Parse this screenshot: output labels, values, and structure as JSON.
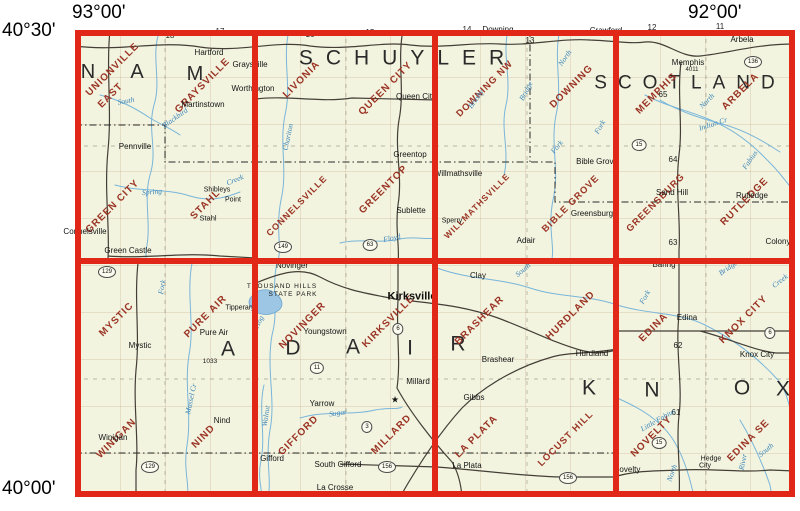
{
  "coords": {
    "top_left": "93°00'",
    "top_right": "92°00'",
    "left_top": "40°30'",
    "left_bottom": "40°00'"
  },
  "map": {
    "background": "#f2f4df",
    "grid_color": "#e02718",
    "quad_name_color": "#9b3425",
    "water_color": "#79b5da",
    "grid": {
      "cols": [
        75,
        255,
        435,
        616,
        795
      ],
      "rows": [
        30,
        261,
        497
      ]
    },
    "cells": [
      {
        "id": "r1c1",
        "quads": [
          "UNIONVILLE EAST",
          "GRAYSVILLE",
          "GREEN CITY",
          "STAHL"
        ]
      },
      {
        "id": "r1c2",
        "quads": [
          "LIVONIA",
          "QUEEN CITY",
          "CONNELSVILLE",
          "GREENTOP"
        ]
      },
      {
        "id": "r1c3",
        "quads": [
          "DOWNING NW",
          "DOWNING",
          "WILLMATHSVILLE",
          "BIBLE GROVE"
        ]
      },
      {
        "id": "r1c4",
        "quads": [
          "MEMPHIS",
          "ARBELA",
          "GREENSBURG",
          "RUTLEDGE"
        ]
      },
      {
        "id": "r2c1",
        "quads": [
          "MYSTIC",
          "PURE AIR",
          "WINIGAN",
          "NIND"
        ]
      },
      {
        "id": "r2c2",
        "quads": [
          "NOVINGER",
          "KIRKSVILLE",
          "GIFFORD",
          "MILLARD"
        ]
      },
      {
        "id": "r2c3",
        "quads": [
          "BRASHEAR",
          "HURDLAND",
          "LA PLATA",
          "LOCUST HILL"
        ]
      },
      {
        "id": "r2c4",
        "quads": [
          "EDINA",
          "KNOX CITY",
          "NOVELTY",
          "EDINA SE"
        ]
      }
    ],
    "labels": [
      {
        "t": "N",
        "cls": "county",
        "x": 88,
        "y": 72
      },
      {
        "t": "A",
        "cls": "county",
        "x": 137,
        "y": 72
      },
      {
        "t": "M",
        "cls": "county",
        "x": 195,
        "y": 74
      },
      {
        "t": "SCHUYLER",
        "cls": "county",
        "x": 408,
        "y": 58,
        "fs": 21,
        "ls": 13
      },
      {
        "t": "SCOTLAND",
        "cls": "county",
        "x": 690,
        "y": 83,
        "fs": 19,
        "ls": 11
      },
      {
        "t": "A",
        "cls": "county",
        "x": 228,
        "y": 349,
        "fs": 21
      },
      {
        "t": "D",
        "cls": "county",
        "x": 293,
        "y": 348,
        "fs": 21
      },
      {
        "t": "A",
        "cls": "county",
        "x": 353,
        "y": 347,
        "fs": 21
      },
      {
        "t": "I",
        "cls": "county",
        "x": 410,
        "y": 348,
        "fs": 21
      },
      {
        "t": "R",
        "cls": "county",
        "x": 458,
        "y": 344,
        "fs": 21
      },
      {
        "t": "K",
        "cls": "county",
        "x": 589,
        "y": 388,
        "fs": 21
      },
      {
        "t": "N",
        "cls": "county",
        "x": 652,
        "y": 390,
        "fs": 21
      },
      {
        "t": "O",
        "cls": "county",
        "x": 742,
        "y": 388,
        "fs": 21
      },
      {
        "t": "X",
        "cls": "county",
        "x": 783,
        "y": 389,
        "fs": 21
      },
      {
        "t": "UNIONVILLE",
        "cls": "quad",
        "x": 113,
        "y": 70,
        "rot": -45
      },
      {
        "t": "EAST",
        "cls": "quad",
        "x": 111,
        "y": 96,
        "rot": -45
      },
      {
        "t": "GRAYSVILLE",
        "cls": "quad",
        "x": 203,
        "y": 86,
        "rot": -45
      },
      {
        "t": "GREEN CITY",
        "cls": "quad",
        "x": 113,
        "y": 207,
        "rot": -45
      },
      {
        "t": "STAHL",
        "cls": "quad",
        "x": 206,
        "y": 205,
        "rot": -45
      },
      {
        "t": "LIVONIA",
        "cls": "quad",
        "x": 302,
        "y": 80,
        "rot": -45
      },
      {
        "t": "QUEEN CITY",
        "cls": "quad",
        "x": 386,
        "y": 89,
        "rot": -45
      },
      {
        "t": "CONNELSVILLE",
        "cls": "quad",
        "x": 297,
        "y": 206,
        "rot": -45,
        "fs": 9
      },
      {
        "t": "GREENTOP",
        "cls": "quad",
        "x": 384,
        "y": 190,
        "rot": -45
      },
      {
        "t": "DOWNING NW",
        "cls": "quad",
        "x": 485,
        "y": 89,
        "rot": -45,
        "fs": 9.5
      },
      {
        "t": "DOWNING",
        "cls": "quad",
        "x": 572,
        "y": 87,
        "rot": -45
      },
      {
        "t": "WILLMATHSVILLE",
        "cls": "quad",
        "x": 477,
        "y": 206,
        "rot": -45,
        "fs": 8.5
      },
      {
        "t": "BIBLE GROVE",
        "cls": "quad",
        "x": 571,
        "y": 204,
        "rot": -45,
        "fs": 9.5
      },
      {
        "t": "MEMPHIS",
        "cls": "quad",
        "x": 657,
        "y": 94,
        "rot": -45
      },
      {
        "t": "ARBELA",
        "cls": "quad",
        "x": 741,
        "y": 92,
        "rot": -45
      },
      {
        "t": "GREENSBURG",
        "cls": "quad",
        "x": 656,
        "y": 203,
        "rot": -45,
        "fs": 9.5
      },
      {
        "t": "RUTLEDGE",
        "cls": "quad",
        "x": 745,
        "y": 202,
        "rot": -45
      },
      {
        "t": "MYSTIC",
        "cls": "quad",
        "x": 117,
        "y": 320,
        "rot": -45
      },
      {
        "t": "PURE AIR",
        "cls": "quad",
        "x": 206,
        "y": 317,
        "rot": -45
      },
      {
        "t": "WINIGAN",
        "cls": "quad",
        "x": 117,
        "y": 439,
        "rot": -45
      },
      {
        "t": "NIND",
        "cls": "quad",
        "x": 204,
        "y": 437,
        "rot": -45
      },
      {
        "t": "NOVINGER",
        "cls": "quad",
        "x": 303,
        "y": 326,
        "rot": -45
      },
      {
        "t": "KIRKSVILLE",
        "cls": "quad",
        "x": 389,
        "y": 322,
        "rot": -45
      },
      {
        "t": "GIFFORD",
        "cls": "quad",
        "x": 299,
        "y": 436,
        "rot": -45
      },
      {
        "t": "MILLARD",
        "cls": "quad",
        "x": 392,
        "y": 435,
        "rot": -45
      },
      {
        "t": "BRASHEAR",
        "cls": "quad",
        "x": 480,
        "y": 321,
        "rot": -45
      },
      {
        "t": "HURDLAND",
        "cls": "quad",
        "x": 571,
        "y": 316,
        "rot": -45
      },
      {
        "t": "LA PLATA",
        "cls": "quad",
        "x": 477,
        "y": 437,
        "rot": -45
      },
      {
        "t": "LOCUST HILL",
        "cls": "quad",
        "x": 566,
        "y": 439,
        "rot": -45,
        "fs": 9.5
      },
      {
        "t": "EDINA",
        "cls": "quad",
        "x": 654,
        "y": 328,
        "rot": -45
      },
      {
        "t": "KNOX CITY",
        "cls": "quad",
        "x": 744,
        "y": 320,
        "rot": -45
      },
      {
        "t": "NOVELTY",
        "cls": "quad",
        "x": 652,
        "y": 437,
        "rot": -45
      },
      {
        "t": "EDINA SE",
        "cls": "quad",
        "x": 749,
        "y": 441,
        "rot": -45
      },
      {
        "t": "Hartford",
        "cls": "town",
        "x": 209,
        "y": 53
      },
      {
        "t": "Graysville",
        "cls": "town",
        "x": 250,
        "y": 65
      },
      {
        "t": "Worthington",
        "cls": "town",
        "x": 253,
        "y": 89
      },
      {
        "t": "Martinstown",
        "cls": "town",
        "x": 203,
        "y": 105
      },
      {
        "t": "Pennville",
        "cls": "town",
        "x": 135,
        "y": 147
      },
      {
        "t": "Queen City",
        "cls": "town",
        "x": 416,
        "y": 97
      },
      {
        "t": "Greentop",
        "cls": "town",
        "x": 410,
        "y": 155
      },
      {
        "t": "Sublette",
        "cls": "town",
        "x": 411,
        "y": 211
      },
      {
        "t": "Downing",
        "cls": "town",
        "x": 498,
        "y": 30
      },
      {
        "t": "Crawford",
        "cls": "town",
        "x": 606,
        "y": 31
      },
      {
        "t": "Arbela",
        "cls": "town",
        "x": 742,
        "y": 40
      },
      {
        "t": "Memphis",
        "cls": "town",
        "x": 688,
        "y": 63
      },
      {
        "t": "Bible Grove",
        "cls": "town",
        "x": 597,
        "y": 162
      },
      {
        "t": "Willmathsville",
        "cls": "town",
        "x": 458,
        "y": 174
      },
      {
        "t": "Greensburg",
        "cls": "town",
        "x": 592,
        "y": 214
      },
      {
        "t": "Shibleys",
        "cls": "town",
        "x": 217,
        "y": 190,
        "fs": 7
      },
      {
        "t": "Point",
        "cls": "town",
        "x": 233,
        "y": 200,
        "fs": 7
      },
      {
        "t": "Stahl",
        "cls": "town",
        "x": 208,
        "y": 218,
        "fs": 7.5
      },
      {
        "t": "Connelsville",
        "cls": "town",
        "x": 85,
        "y": 232
      },
      {
        "t": "Green Castle",
        "cls": "town",
        "x": 128,
        "y": 251
      },
      {
        "t": "Rutledge",
        "cls": "town",
        "x": 752,
        "y": 196
      },
      {
        "t": "Sand Hill",
        "cls": "town",
        "x": 672,
        "y": 193
      },
      {
        "t": "Colony",
        "cls": "town",
        "x": 778,
        "y": 242
      },
      {
        "t": "Baring",
        "cls": "town",
        "x": 664,
        "y": 265
      },
      {
        "t": "Mystic",
        "cls": "town",
        "x": 140,
        "y": 346
      },
      {
        "t": "Pure Air",
        "cls": "town",
        "x": 214,
        "y": 333
      },
      {
        "t": "Tipperary",
        "cls": "town",
        "x": 240,
        "y": 308,
        "fs": 7
      },
      {
        "t": "THOUSAND HILLS",
        "cls": "town",
        "x": 282,
        "y": 287,
        "fs": 6.5,
        "ls": 1
      },
      {
        "t": "STATE PARK",
        "cls": "town",
        "x": 293,
        "y": 295,
        "fs": 6.5,
        "ls": 1
      },
      {
        "t": "Novinger",
        "cls": "town",
        "x": 292,
        "y": 266
      },
      {
        "t": "Kirksville",
        "cls": "city",
        "x": 412,
        "y": 297
      },
      {
        "t": "Youngstown",
        "cls": "town",
        "x": 325,
        "y": 332
      },
      {
        "t": "Millard",
        "cls": "town",
        "x": 418,
        "y": 382
      },
      {
        "t": "★",
        "cls": "marker",
        "x": 395,
        "y": 400
      },
      {
        "t": "Yarrow",
        "cls": "town",
        "x": 322,
        "y": 404
      },
      {
        "t": "Gifford",
        "cls": "town",
        "x": 272,
        "y": 459
      },
      {
        "t": "South Gifford",
        "cls": "town",
        "x": 338,
        "y": 465
      },
      {
        "t": "La Crosse",
        "cls": "town",
        "x": 335,
        "y": 488
      },
      {
        "t": "Gibbs",
        "cls": "town",
        "x": 474,
        "y": 398
      },
      {
        "t": "Brashear",
        "cls": "town",
        "x": 498,
        "y": 360
      },
      {
        "t": "Clay",
        "cls": "town",
        "x": 478,
        "y": 276
      },
      {
        "t": "Hurdland",
        "cls": "town",
        "x": 592,
        "y": 354
      },
      {
        "t": "Adair",
        "cls": "town",
        "x": 526,
        "y": 241
      },
      {
        "t": "Sperry",
        "cls": "town",
        "x": 452,
        "y": 221,
        "fs": 7
      },
      {
        "t": "La Plata",
        "cls": "town",
        "x": 467,
        "y": 466
      },
      {
        "t": "Novelty",
        "cls": "town",
        "x": 627,
        "y": 470
      },
      {
        "t": "Hedge",
        "cls": "town",
        "x": 711,
        "y": 459,
        "fs": 7
      },
      {
        "t": "City",
        "cls": "town",
        "x": 705,
        "y": 466,
        "fs": 7
      },
      {
        "t": "Edina",
        "cls": "town",
        "x": 687,
        "y": 318
      },
      {
        "t": "Knox City",
        "cls": "town",
        "x": 757,
        "y": 355
      },
      {
        "t": "Nind",
        "cls": "town",
        "x": 222,
        "y": 421
      },
      {
        "t": "Winigan",
        "cls": "town",
        "x": 113,
        "y": 438
      },
      {
        "t": "18",
        "cls": "num",
        "x": 170,
        "y": 36
      },
      {
        "t": "17",
        "cls": "num",
        "x": 220,
        "y": 32
      },
      {
        "t": "16",
        "cls": "num",
        "x": 310,
        "y": 35
      },
      {
        "t": "15",
        "cls": "num",
        "x": 370,
        "y": 33
      },
      {
        "t": "14",
        "cls": "num",
        "x": 467,
        "y": 30
      },
      {
        "t": "13",
        "cls": "num",
        "x": 530,
        "y": 41
      },
      {
        "t": "12",
        "cls": "num",
        "x": 652,
        "y": 28
      },
      {
        "t": "11",
        "cls": "num",
        "x": 720,
        "y": 27
      },
      {
        "t": "65",
        "cls": "num",
        "x": 663,
        "y": 95
      },
      {
        "t": "64",
        "cls": "num",
        "x": 673,
        "y": 160
      },
      {
        "t": "63",
        "cls": "num",
        "x": 673,
        "y": 243
      },
      {
        "t": "62",
        "cls": "num",
        "x": 678,
        "y": 346
      },
      {
        "t": "61",
        "cls": "num",
        "x": 676,
        "y": 413
      },
      {
        "t": "1033",
        "cls": "num",
        "x": 210,
        "y": 362,
        "fs": 6.5
      },
      {
        "t": "4011",
        "cls": "num",
        "x": 692,
        "y": 70,
        "fs": 6
      },
      {
        "t": "136",
        "cls": "shield",
        "x": 753,
        "y": 62
      },
      {
        "t": "15",
        "cls": "shield",
        "x": 639,
        "y": 145
      },
      {
        "t": "15",
        "cls": "shield",
        "x": 659,
        "y": 443
      },
      {
        "t": "149",
        "cls": "shield",
        "x": 283,
        "y": 247
      },
      {
        "t": "63",
        "cls": "shield",
        "x": 370,
        "y": 245
      },
      {
        "t": "129",
        "cls": "shield",
        "x": 107,
        "y": 272
      },
      {
        "t": "129",
        "cls": "shield",
        "x": 150,
        "y": 467
      },
      {
        "t": "6",
        "cls": "shield",
        "x": 398,
        "y": 329
      },
      {
        "t": "6",
        "cls": "shield",
        "x": 770,
        "y": 333
      },
      {
        "t": "11",
        "cls": "shield",
        "x": 317,
        "y": 368
      },
      {
        "t": "3",
        "cls": "shield",
        "x": 367,
        "y": 427
      },
      {
        "t": "156",
        "cls": "shield",
        "x": 387,
        "y": 467
      },
      {
        "t": "156",
        "cls": "shield",
        "x": 568,
        "y": 478
      },
      {
        "t": "South",
        "cls": "river",
        "x": 126,
        "y": 101,
        "rot": -10
      },
      {
        "t": "Blackbird",
        "cls": "river",
        "x": 175,
        "y": 118,
        "rot": -35
      },
      {
        "t": "Chariton",
        "cls": "river",
        "x": 288,
        "y": 137,
        "rot": -78
      },
      {
        "t": "Spring",
        "cls": "river",
        "x": 152,
        "y": 192,
        "rot": -5
      },
      {
        "t": "Creek",
        "cls": "river",
        "x": 235,
        "y": 180,
        "rot": -22
      },
      {
        "t": "Floyd",
        "cls": "river",
        "x": 392,
        "y": 238,
        "rot": -12
      },
      {
        "t": "Brushy",
        "cls": "river",
        "x": 476,
        "y": 99,
        "rot": -55
      },
      {
        "t": "Bridge",
        "cls": "river",
        "x": 526,
        "y": 91,
        "rot": -62
      },
      {
        "t": "North",
        "cls": "river",
        "x": 565,
        "y": 58,
        "rot": -55
      },
      {
        "t": "Fork",
        "cls": "river",
        "x": 600,
        "y": 127,
        "rot": -60
      },
      {
        "t": "Fork",
        "cls": "river",
        "x": 557,
        "y": 147,
        "rot": -50
      },
      {
        "t": "North",
        "cls": "river",
        "x": 707,
        "y": 101,
        "rot": -45
      },
      {
        "t": "Indian Cr",
        "cls": "river",
        "x": 713,
        "y": 124,
        "rot": -18
      },
      {
        "t": "Fabius",
        "cls": "river",
        "x": 750,
        "y": 160,
        "rot": -55
      },
      {
        "t": "Fork",
        "cls": "river",
        "x": 645,
        "y": 297,
        "rot": -60
      },
      {
        "t": "Bridge",
        "cls": "river",
        "x": 728,
        "y": 268,
        "rot": -35
      },
      {
        "t": "Creek",
        "cls": "river",
        "x": 780,
        "y": 281,
        "rot": -38
      },
      {
        "t": "South",
        "cls": "river",
        "x": 523,
        "y": 270,
        "rot": -40
      },
      {
        "t": "Fork",
        "cls": "river",
        "x": 162,
        "y": 287,
        "rot": -80
      },
      {
        "t": "Hog",
        "cls": "river",
        "x": 259,
        "y": 322,
        "rot": -65
      },
      {
        "t": "Mussel Cr",
        "cls": "river",
        "x": 191,
        "y": 399,
        "rot": -78
      },
      {
        "t": "Walnut",
        "cls": "river",
        "x": 266,
        "y": 416,
        "rot": -82
      },
      {
        "t": "Sugar",
        "cls": "river",
        "x": 338,
        "y": 413,
        "rot": -8
      },
      {
        "t": "Little Fabius",
        "cls": "river",
        "x": 658,
        "y": 420,
        "rot": -30
      },
      {
        "t": "North",
        "cls": "river",
        "x": 672,
        "y": 473,
        "rot": -70
      },
      {
        "t": "South",
        "cls": "river",
        "x": 766,
        "y": 450,
        "rot": -40
      },
      {
        "t": "River",
        "cls": "river",
        "x": 743,
        "y": 462,
        "rot": -78
      }
    ]
  }
}
